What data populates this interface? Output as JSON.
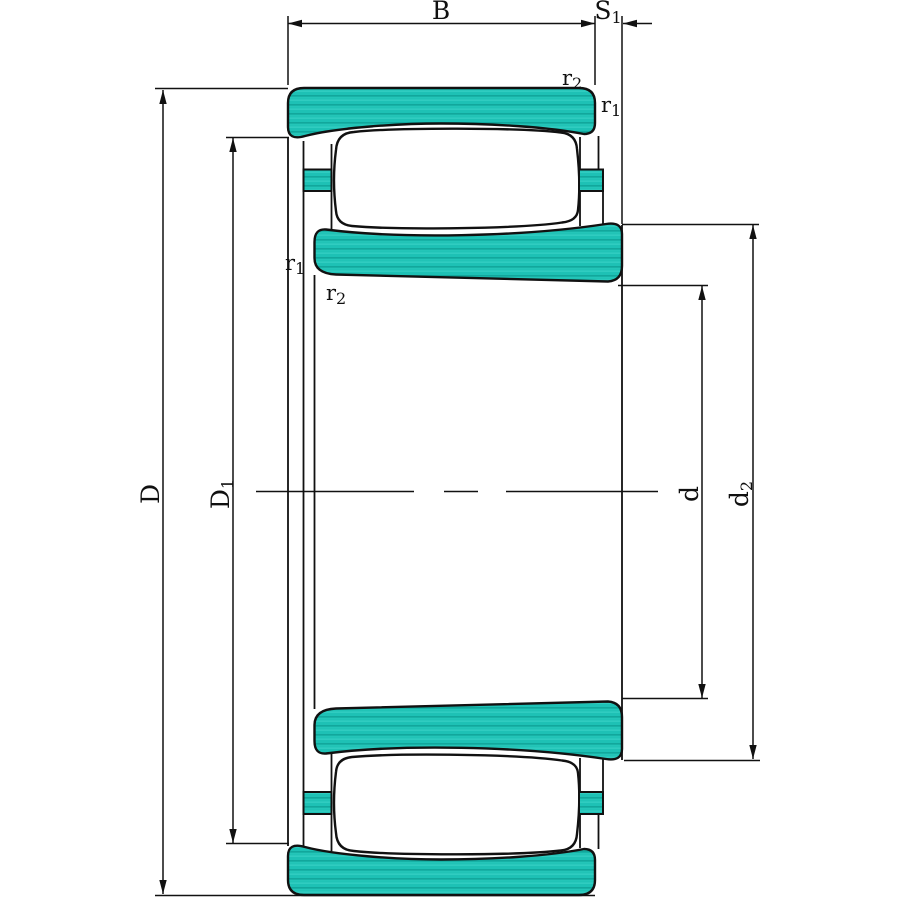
{
  "figure": {
    "title": "bearing-cross-section-drawing",
    "description": "Cross-section technical drawing of a toroidal roller bearing with dimension callouts",
    "colors": {
      "ring_fill": "#1ec1b5",
      "line": "#111111",
      "background": "#ffffff"
    },
    "dimensions": {
      "B": {
        "base": "B",
        "sub": ""
      },
      "S1": {
        "base": "S",
        "sub": "1"
      },
      "D": {
        "base": "D",
        "sub": ""
      },
      "D1": {
        "base": "D",
        "sub": "1"
      },
      "d": {
        "base": "d",
        "sub": ""
      },
      "d2": {
        "base": "d",
        "sub": "2"
      },
      "r1": {
        "base": "r",
        "sub": "1"
      },
      "r2": {
        "base": "r",
        "sub": "2"
      }
    }
  }
}
